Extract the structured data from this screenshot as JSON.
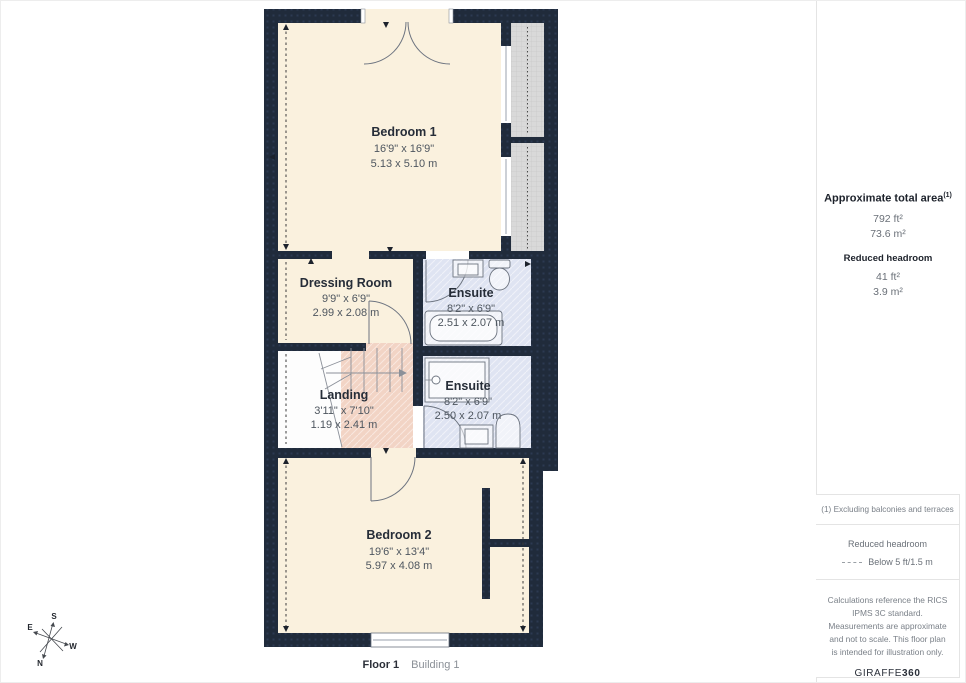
{
  "rooms": [
    {
      "name": "Bedroom 1",
      "dims_ft": "16'9\" x 16'9\"",
      "dims_m": "5.13 x 5.10 m"
    },
    {
      "name": "Dressing Room",
      "dims_ft": "9'9\" x 6'9\"",
      "dims_m": "2.99 x 2.08 m"
    },
    {
      "name": "Ensuite",
      "dims_ft": "8'2\" x 6'9\"",
      "dims_m": "2.51 x 2.07 m"
    },
    {
      "name": "Landing",
      "dims_ft": "3'11\" x 7'10\"",
      "dims_m": "1.19 x 2.41 m"
    },
    {
      "name": "Ensuite",
      "dims_ft": "8'2\" x 6'9\"",
      "dims_m": "2.50 x 2.07 m"
    },
    {
      "name": "Bedroom 2",
      "dims_ft": "19'6\" x 13'4\"",
      "dims_m": "5.97 x 4.08 m"
    }
  ],
  "sidebar": {
    "area_heading": "Approximate total area",
    "area_sup": "(1)",
    "area_ft": "792 ft²",
    "area_m": "73.6 m²",
    "rh_heading": "Reduced headroom",
    "rh_ft": "41 ft²",
    "rh_m": "3.9 m²",
    "note1": "(1) Excluding balconies and terraces",
    "legend_title": "Reduced headroom",
    "legend_label": "Below 5 ft/1.5 m",
    "disclaimer": "Calculations reference the RICS IPMS 3C standard. Measurements are approximate and not to scale. This floor plan is intended for illustration only.",
    "brand_a": "GIRAFFE",
    "brand_b": "360"
  },
  "footer": {
    "floor": "Floor 1",
    "building": "Building 1"
  },
  "compass": {
    "n": "N",
    "s": "S",
    "e": "E",
    "w": "W"
  },
  "colors": {
    "wall": "#202b3b",
    "cream": "#faf1de",
    "blue": "#dfe4f2",
    "pink": "#f2d4c5",
    "terrace": "#d9d9d9",
    "landing": "#fdfdfd",
    "border": "#e4e4e4",
    "textDark": "#262d38",
    "textGray": "#4e565f",
    "noteGray": "#7a8088"
  }
}
